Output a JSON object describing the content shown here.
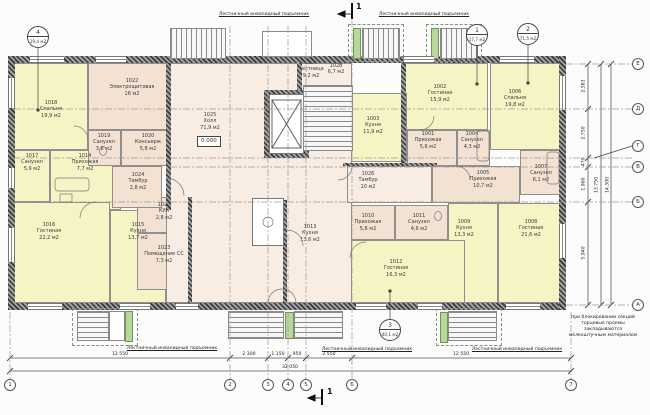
{
  "plan": {
    "elevation": "0.000",
    "section_mark": "1",
    "lift_label": "Лестничный инвалидный подъемник",
    "note_lines": [
      "при блокировании секций",
      "торцевые проемы закладываются",
      "мелкоштучным материалом"
    ]
  },
  "rooms": [
    {
      "id": "1025",
      "name": "Холл",
      "area": "71,9 м2"
    },
    {
      "id": "1026",
      "name": "Тамбур",
      "area": "10 м2"
    },
    {
      "id": "1018",
      "name": "Спальня",
      "area": "19,9 м2"
    },
    {
      "id": "1022",
      "name": "Электрощитовая",
      "area": "16 м2"
    },
    {
      "id": "1019",
      "name": "Санузел",
      "area": "3,8 м2"
    },
    {
      "id": "1020",
      "name": "Консьерж",
      "area": "5,8 м2"
    },
    {
      "id": "1017",
      "name": "Санузел",
      "area": "5,9 м2"
    },
    {
      "id": "1014",
      "name": "Прихожая",
      "area": "7,7 м2"
    },
    {
      "id": "1024",
      "name": "Тамбур",
      "area": "2,8 м2"
    },
    {
      "id": "1016",
      "name": "Гостиная",
      "area": "22,2 м2"
    },
    {
      "id": "1015",
      "name": "Кухня",
      "area": "13,7 м2"
    },
    {
      "id": "1021",
      "name": "КУИ",
      "area": "2,8 м2"
    },
    {
      "id": "1023",
      "name": "Помещение СС",
      "area": "7,3 м2"
    },
    {
      "id": "1027",
      "name": "Лестница",
      "area": "9,2 м2"
    },
    {
      "id": "1028",
      "name": "",
      "area": "6,7 м2"
    },
    {
      "id": "1001",
      "name": "Прихожая",
      "area": "5,6 м2"
    },
    {
      "id": "1002",
      "name": "Гостиная",
      "area": "15,9 м2"
    },
    {
      "id": "1003",
      "name": "Кухня",
      "area": "11,9 м2"
    },
    {
      "id": "1004",
      "name": "Санузел",
      "area": "4,3 м2"
    },
    {
      "id": "1005",
      "name": "Прихожая",
      "area": "10,7 м2"
    },
    {
      "id": "1006",
      "name": "Спальня",
      "area": "19,8 м2"
    },
    {
      "id": "1007",
      "name": "Санузел",
      "area": "6,1 м2"
    },
    {
      "id": "1008",
      "name": "Гостиная",
      "area": "21,6 м2"
    },
    {
      "id": "1009",
      "name": "Кухня",
      "area": "13,3 м2"
    },
    {
      "id": "1010",
      "name": "Прихожая",
      "area": "5,6 м2"
    },
    {
      "id": "1011",
      "name": "Санузел",
      "area": "4,6 м2"
    },
    {
      "id": "1012",
      "name": "Гостиная",
      "area": "16,3 м2"
    },
    {
      "id": "1013",
      "name": "Кухня",
      "area": "13,6 м2"
    }
  ],
  "apartment_markers": [
    {
      "num": "4",
      "area": "19,4 м2"
    },
    {
      "num": "1",
      "area": "17,7 м2"
    },
    {
      "num": "2",
      "area": "71,5 м2"
    },
    {
      "num": "3",
      "area": "40,1 м2"
    }
  ],
  "grid": {
    "columns": [
      "1",
      "2",
      "3",
      "4",
      "5",
      "6",
      "7"
    ],
    "rows": [
      "Е",
      "Д",
      "Г",
      "В",
      "Б",
      "А"
    ]
  },
  "dimensions": {
    "bottom_segments": [
      "12 550",
      "2 300",
      "1 150",
      "950",
      "2 550",
      "12 550"
    ],
    "bottom_total": "32 050",
    "right_segments": [
      "2.583",
      "2.750",
      "470",
      "1.960",
      "5.940"
    ],
    "right_totals": [
      "13.750",
      "14.300"
    ]
  },
  "colors": {
    "room_yellow": "#f6f4c4",
    "room_tan": "#f3e2d2",
    "hall_pink": "#f8ece3",
    "lift_green": "#b9d69c",
    "wall_dark": "#3a3a3a"
  }
}
